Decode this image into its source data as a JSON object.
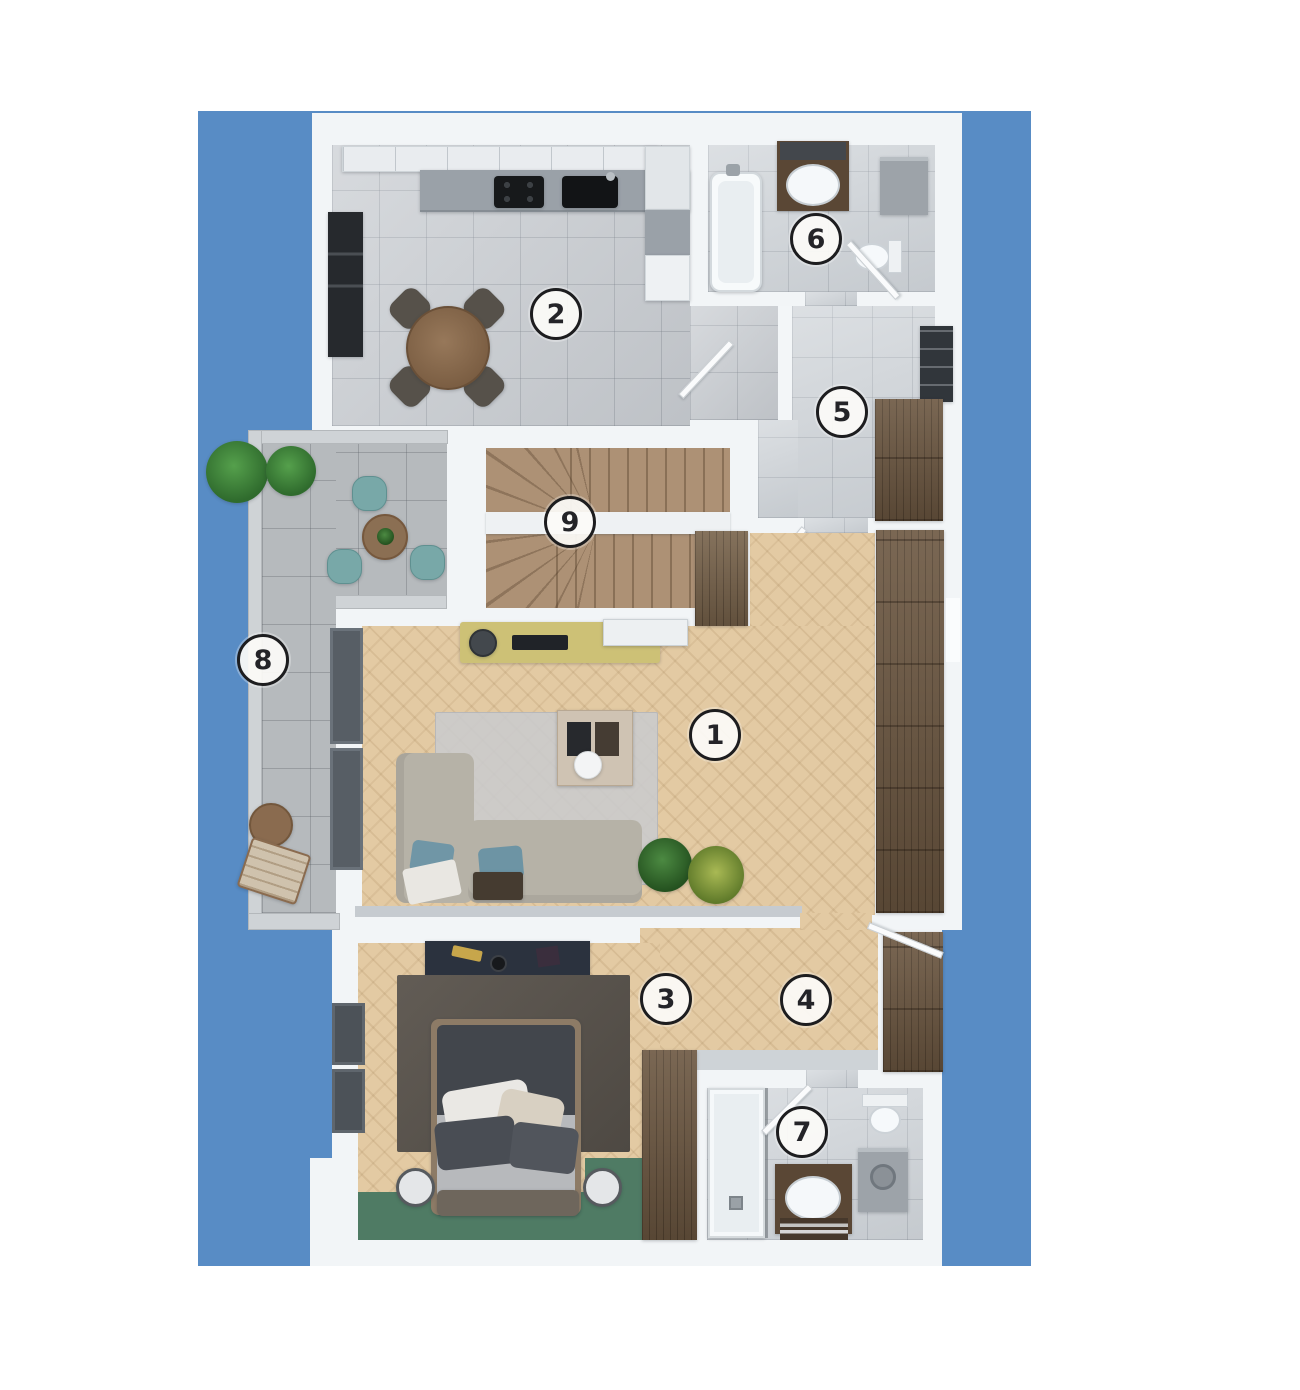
{
  "scene": {
    "canvas_width": 1300,
    "canvas_height": 1390,
    "page_background": "#ffffff",
    "backdrop_color": "#588cc5"
  },
  "rooms": [
    {
      "id": "living-room",
      "number": "1"
    },
    {
      "id": "kitchen",
      "number": "2"
    },
    {
      "id": "bedroom",
      "number": "3"
    },
    {
      "id": "walk-in-closet",
      "number": "4"
    },
    {
      "id": "hallway",
      "number": "5"
    },
    {
      "id": "bathroom-main",
      "number": "6"
    },
    {
      "id": "bathroom-second",
      "number": "7"
    },
    {
      "id": "balcony",
      "number": "8"
    },
    {
      "id": "staircase",
      "number": "9"
    }
  ],
  "materials": {
    "wall": "#f3f6f8",
    "wood_floor": "#e3caa3",
    "kitchen_tile": "#c8ccd1",
    "marble_tile": "#cdd2d7",
    "balcony_tile": "#b6babd",
    "stair_wood": "#ad9175",
    "cabinet_wood": "#6b5640",
    "accent_green_floor": "#4f7b64",
    "badge_ring": "#1d1d1f"
  }
}
